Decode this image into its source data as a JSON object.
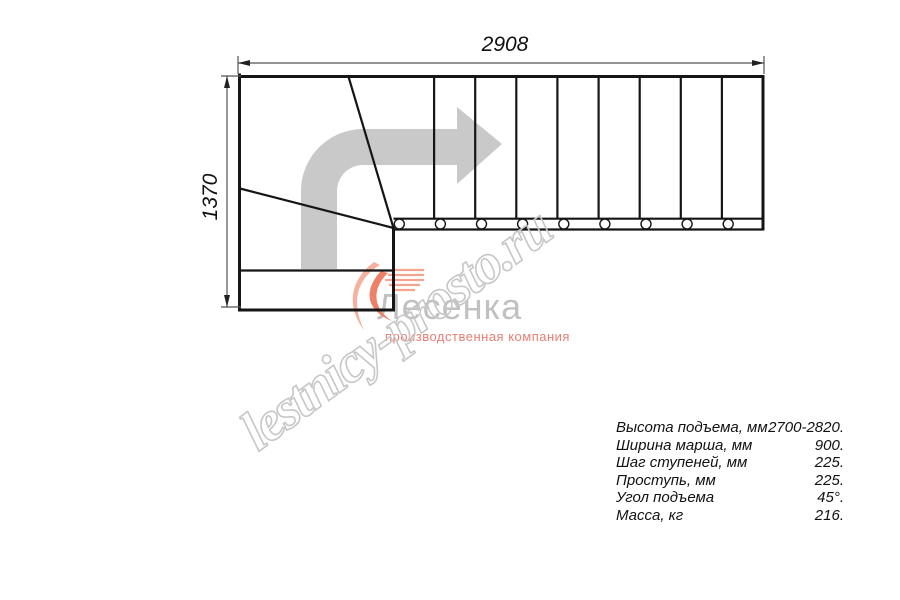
{
  "drawing": {
    "type": "stair-plan-top-view",
    "dimensions": {
      "width_mm": "2908",
      "height_mm": "1370"
    }
  },
  "watermark": {
    "text": "lestnicy-prosto.ru"
  },
  "logo": {
    "company": "Лесенка",
    "tagline": "производственная компания"
  },
  "specs": {
    "rows": [
      {
        "label": "Высота подъема, мм",
        "value": "2700-2820."
      },
      {
        "label": "Ширина марша, мм",
        "value": "900."
      },
      {
        "label": "Шаг ступеней, мм",
        "value": "225."
      },
      {
        "label": "Проступь, мм",
        "value": "225."
      },
      {
        "label": "Угол подъема",
        "value": "45°."
      },
      {
        "label": "Масса, кг",
        "value": "216."
      }
    ]
  },
  "icons": {
    "direction_arrow": "right-turn-arrow",
    "balusters": "circle-markers",
    "logo_swoosh": "orange-swoosh"
  },
  "colors": {
    "line": "#151515",
    "dimension_line": "#555555",
    "arrow_gray": "#c9c9c9",
    "watermark_gray": "#c7c7c7",
    "logo_gray": "#c1c1c1",
    "logo_red": "#e87e74",
    "swoosh_orange": "#ee8068",
    "swoosh_light": "#f6b19c"
  }
}
